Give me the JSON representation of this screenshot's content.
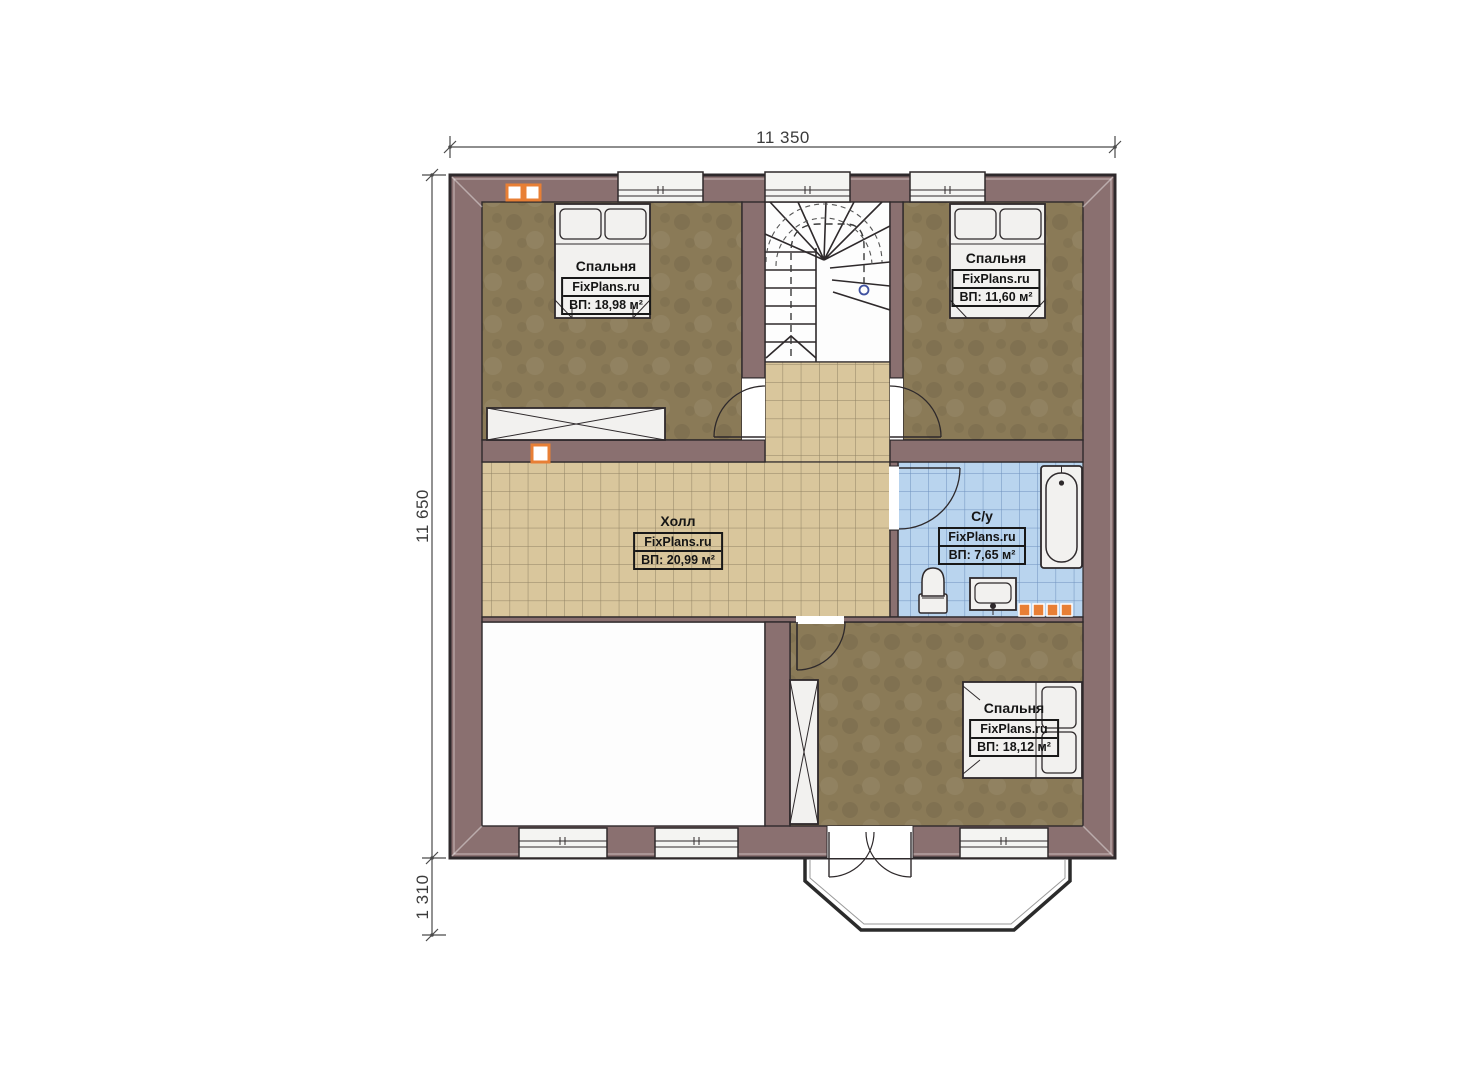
{
  "title": "План этажа",
  "dimensions": {
    "top": "11 350",
    "left": "11 650",
    "bottom_left": "1 310"
  },
  "rooms": {
    "bedroom_tl": {
      "name": "Спальня",
      "brand": "FixPlans.ru",
      "area": "ВП: 18,98 м²"
    },
    "bedroom_tr": {
      "name": "Спальня",
      "brand": "FixPlans.ru",
      "area": "ВП: 11,60 м²"
    },
    "hall": {
      "name": "Холл",
      "brand": "FixPlans.ru",
      "area": "ВП: 20,99 м²"
    },
    "bathroom": {
      "name": "С/у",
      "brand": "FixPlans.ru",
      "area": "ВП: 7,65 м²"
    },
    "bedroom_br": {
      "name": "Спальня",
      "brand": "FixPlans.ru",
      "area": "ВП: 18,12 м²"
    }
  },
  "colors": {
    "wall": "#8a7070",
    "outline": "#2e292b",
    "floor_wood": "#8a7a57",
    "tile_beige": "#d9c69c",
    "tile_blue": "#b9d4ee",
    "accent_orange": "#e87f35"
  }
}
